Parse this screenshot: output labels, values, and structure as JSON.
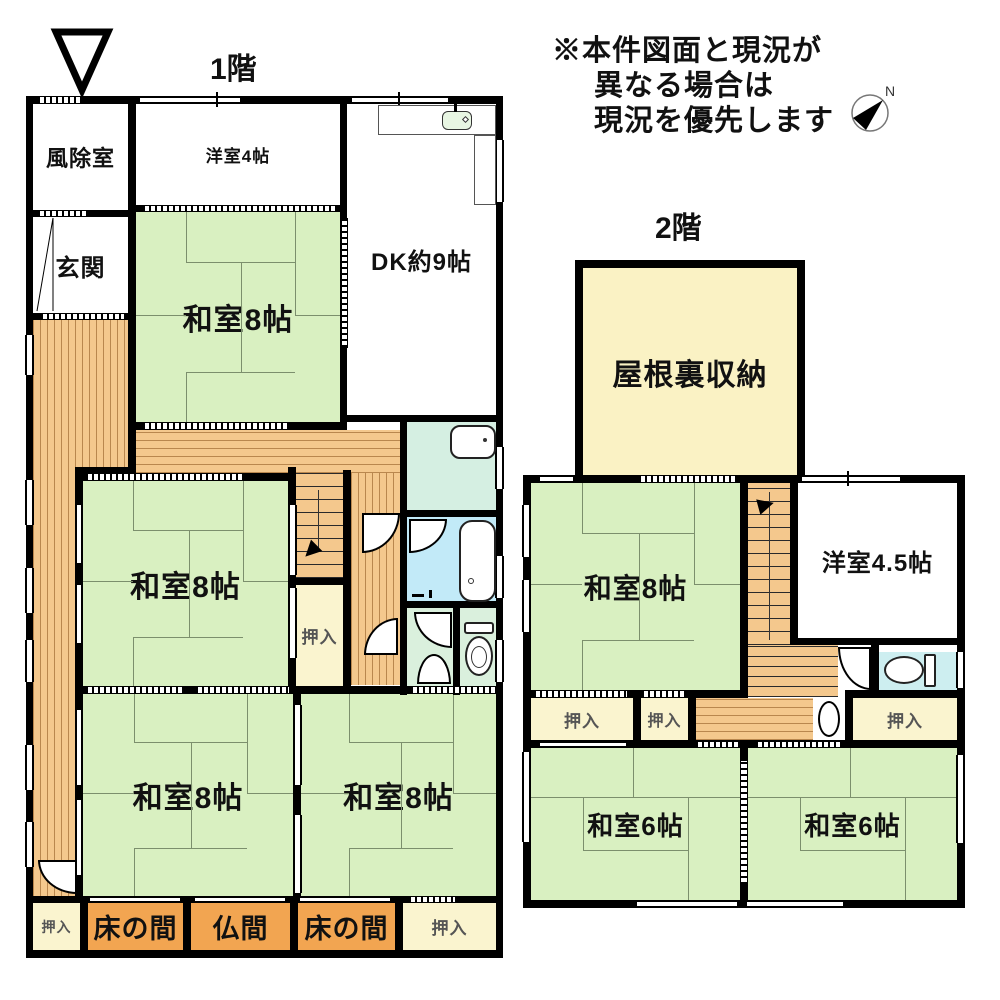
{
  "header": {
    "floor1_title": "1階",
    "floor2_title": "2階"
  },
  "notice": {
    "line1": "※本件図面と現況が",
    "line2": "異なる場合は",
    "line3": "現況を優先します"
  },
  "compass": {
    "north_label": "N"
  },
  "floor1": {
    "rooms": {
      "fujoshitsu": "風除室",
      "genkan": "玄関",
      "yoshitsu4": "洋室4帖",
      "dk": "DK約9帖",
      "washitsu8_ne": "和室8帖",
      "washitsu8_mid": "和室8帖",
      "washitsu8_sw": "和室8帖",
      "washitsu8_se": "和室8帖",
      "oshiire_mid": "押入",
      "oshiire_sw": "押入",
      "tokonoma_left": "床の間",
      "butsuma": "仏間",
      "tokonoma_right": "床の間",
      "oshiire_se": "押入"
    }
  },
  "floor2": {
    "rooms": {
      "attic": "屋根裏収納",
      "washitsu8": "和室8帖",
      "yoshitsu45": "洋室4.5帖",
      "oshiire_1": "押入",
      "oshiire_2": "押入",
      "oshiire_3": "押入",
      "washitsu6_left": "和室6帖",
      "washitsu6_right": "和室6帖"
    }
  },
  "palette": {
    "wall": "#000000",
    "paper": "#ffffff",
    "tatami": "#d9f0c1",
    "tatami_line": "#7c8f6d",
    "wood": "#f4c88d",
    "wood_line": "#b9874e",
    "tread": "#2a2a2a",
    "tokonoma": "#f2a551",
    "closet": "#faf4cf",
    "attic": "#faf2c4",
    "washroom": "#d5efe2",
    "bath": "#c2eaf8",
    "wc": "#daf0dd",
    "wc2": "#cdeef0",
    "ink": "#111111",
    "gray_ink": "#555555"
  }
}
